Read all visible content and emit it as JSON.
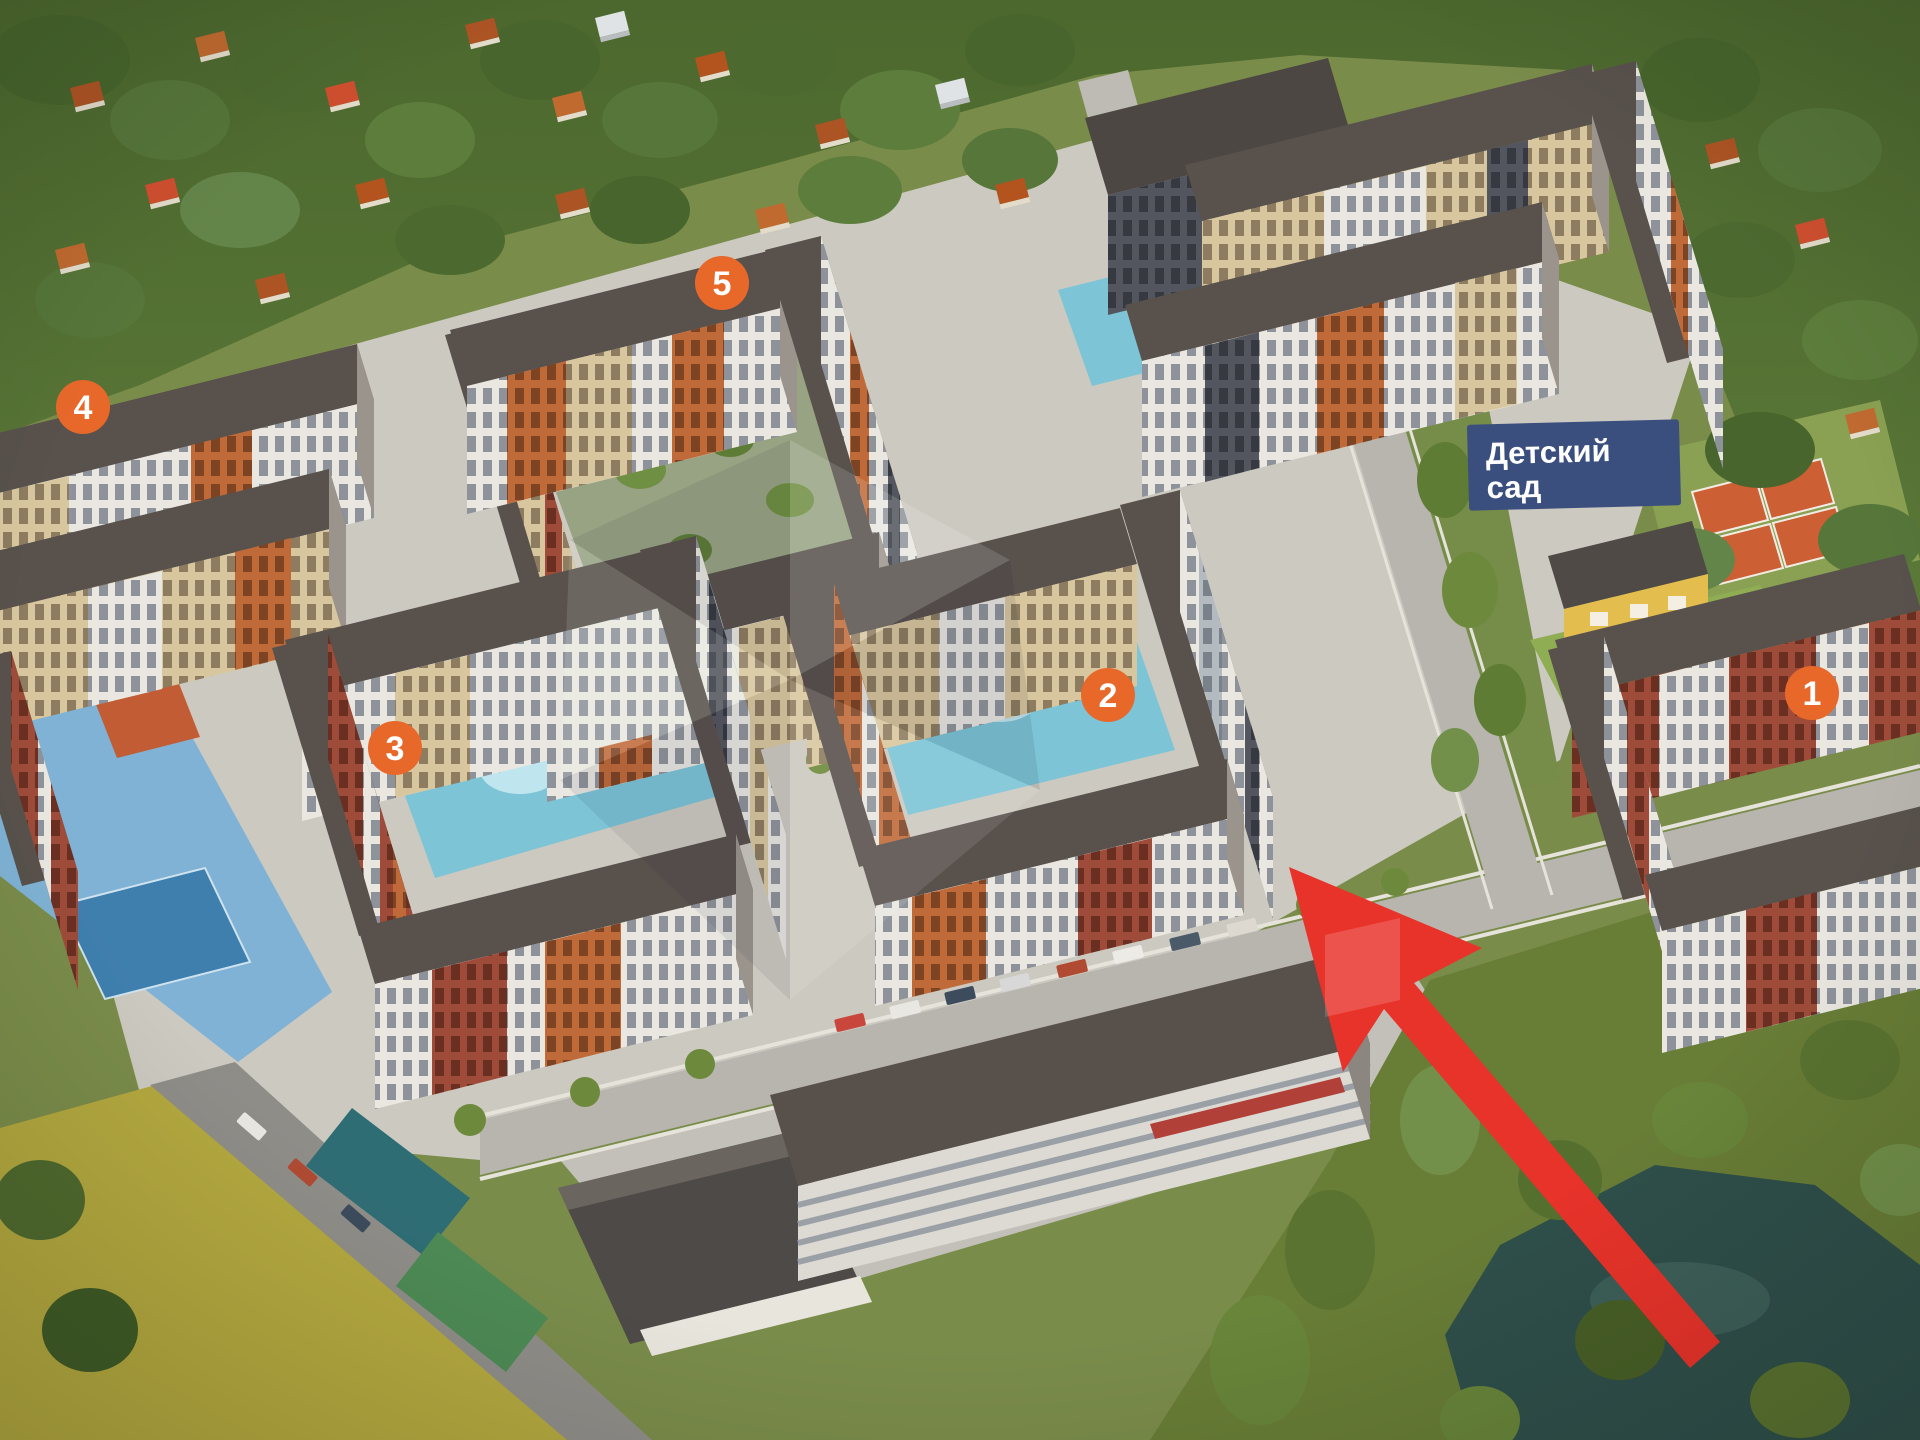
{
  "scene": {
    "view": "aerial 3D masterplan rendering",
    "site": "residential complex with numbered apartment buildings, kindergarten, tennis courts, parking garage, pond and field",
    "arrow": "red arrow pointing at building 2"
  },
  "badges": {
    "b1": "1",
    "b2": "2",
    "b3": "3",
    "b4": "4",
    "b5": "5"
  },
  "kindergarten_label": {
    "line1": "Детский",
    "line2": "сад"
  },
  "colors": {
    "badge_orange": "#e8682a",
    "label_blue": "#3b4f7e",
    "label_text": "#ffffff",
    "arrow_red": "#e8332a",
    "pool_blue": "#7cc4d6",
    "pond_teal": "#2f4f4a",
    "field_yellow_green": "#b3a83f",
    "tennis_orange": "#cc5f33"
  }
}
